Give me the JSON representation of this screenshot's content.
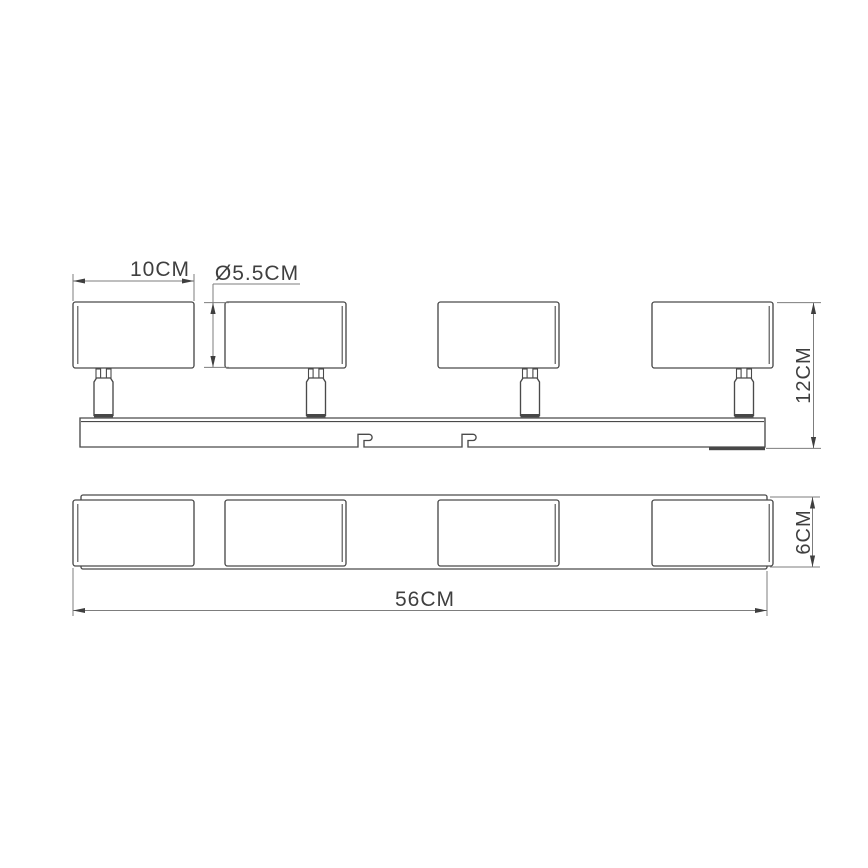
{
  "drawing": {
    "background": "#ffffff",
    "object_line_color": "#4a4a4a",
    "dimension_line_color": "#7d7d7d",
    "text_color": "#3f3f3f"
  },
  "product": {
    "views": [
      {
        "id": "side-view",
        "spotlight_heads": 4,
        "swivel_stems": 4,
        "track_mounting_slots": 2
      },
      {
        "id": "bottom-view",
        "spotlight_heads": 4
      }
    ]
  },
  "dimensions": {
    "head_width": {
      "label": "10CM",
      "value": 10,
      "unit": "CM"
    },
    "head_diameter": {
      "label": "Ø5.5CM",
      "value": 5.5,
      "unit": "CM",
      "symbol": "Ø"
    },
    "overall_height": {
      "label": "12CM",
      "value": 12,
      "unit": "CM"
    },
    "base_depth": {
      "label": "6CM",
      "value": 6,
      "unit": "CM"
    },
    "base_length": {
      "label": "56CM",
      "value": 56,
      "unit": "CM"
    }
  }
}
